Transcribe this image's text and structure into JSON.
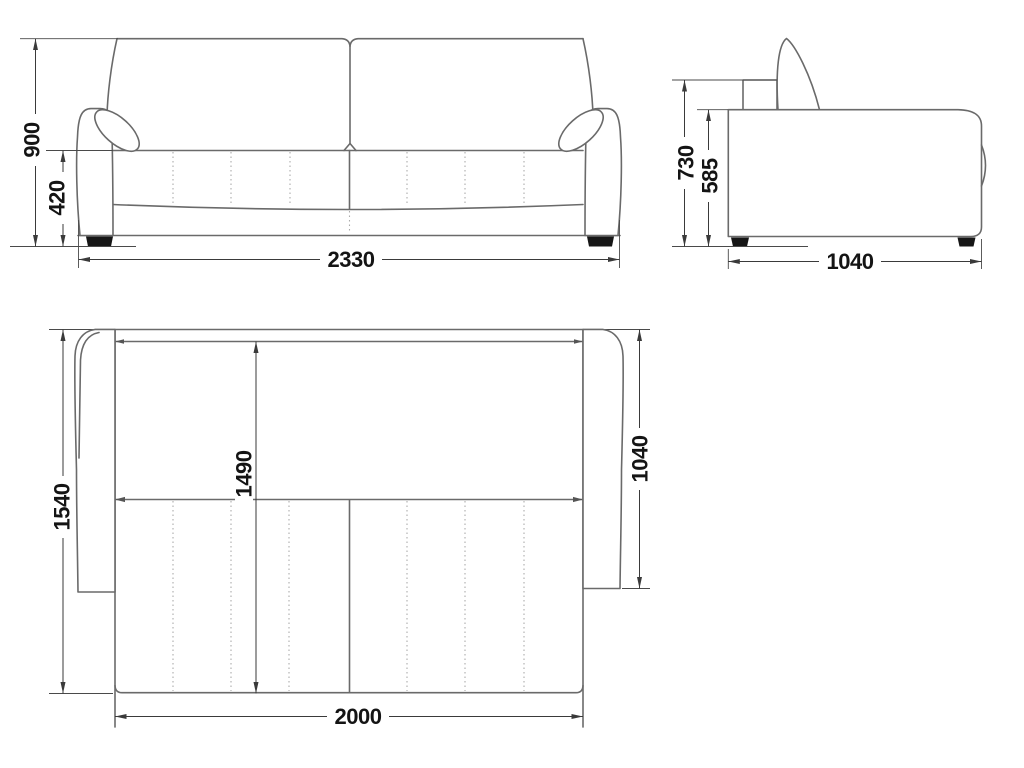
{
  "drawing": {
    "views": {
      "front": {
        "overall_height": "900",
        "seat_height": "420",
        "overall_width": "2330"
      },
      "side": {
        "overall_height": "730",
        "body_height": "585",
        "overall_depth": "1040"
      },
      "top": {
        "overall_depth": "1540",
        "sleeping_length": "1490",
        "side_section_depth": "1040",
        "sleeping_width": "2000"
      }
    },
    "colors": {
      "background": "#ffffff",
      "outline": "#6a6a6a",
      "dimension_line": "#3a3a3a",
      "label_text": "#141414",
      "dotted_seam": "#ababab",
      "leg_fill": "#161616"
    }
  }
}
